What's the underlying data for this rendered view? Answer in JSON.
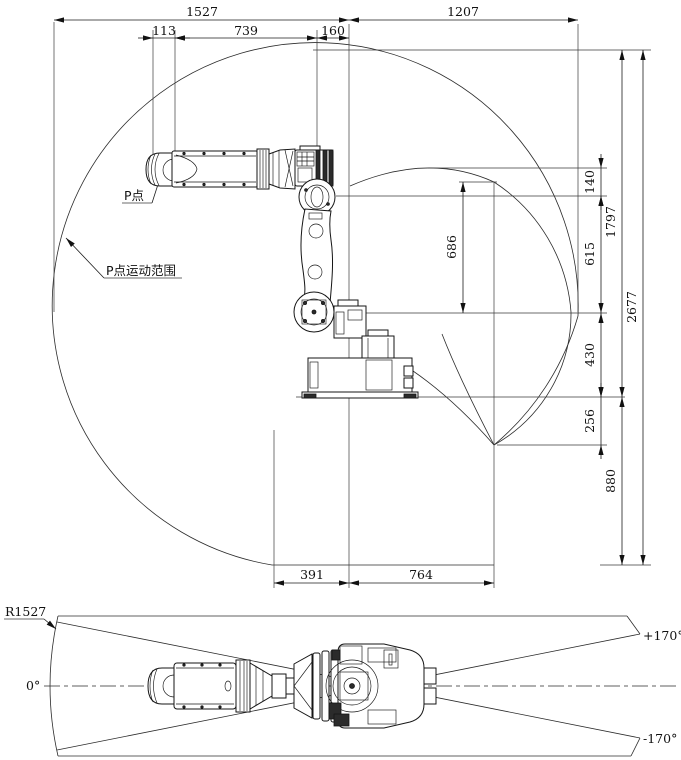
{
  "side_view": {
    "dims": {
      "d1527": "1527",
      "d1207": "1207",
      "d113": "113",
      "d739": "739",
      "d160": "160",
      "d391": "391",
      "d764": "764",
      "d140": "140",
      "d1797": "1797",
      "d615": "615",
      "d686": "686",
      "d2677": "2677",
      "d430": "430",
      "d256": "256",
      "d880": "880"
    },
    "labels": {
      "p_point": "P点",
      "p_range": "P点运动范围"
    }
  },
  "plan_view": {
    "dims": {
      "radius": "R1527"
    },
    "labels": {
      "zero": "0°",
      "plus": "+170°",
      "minus": "-170°"
    }
  },
  "colors": {
    "line": "#1a1a1a",
    "background": "#ffffff"
  }
}
